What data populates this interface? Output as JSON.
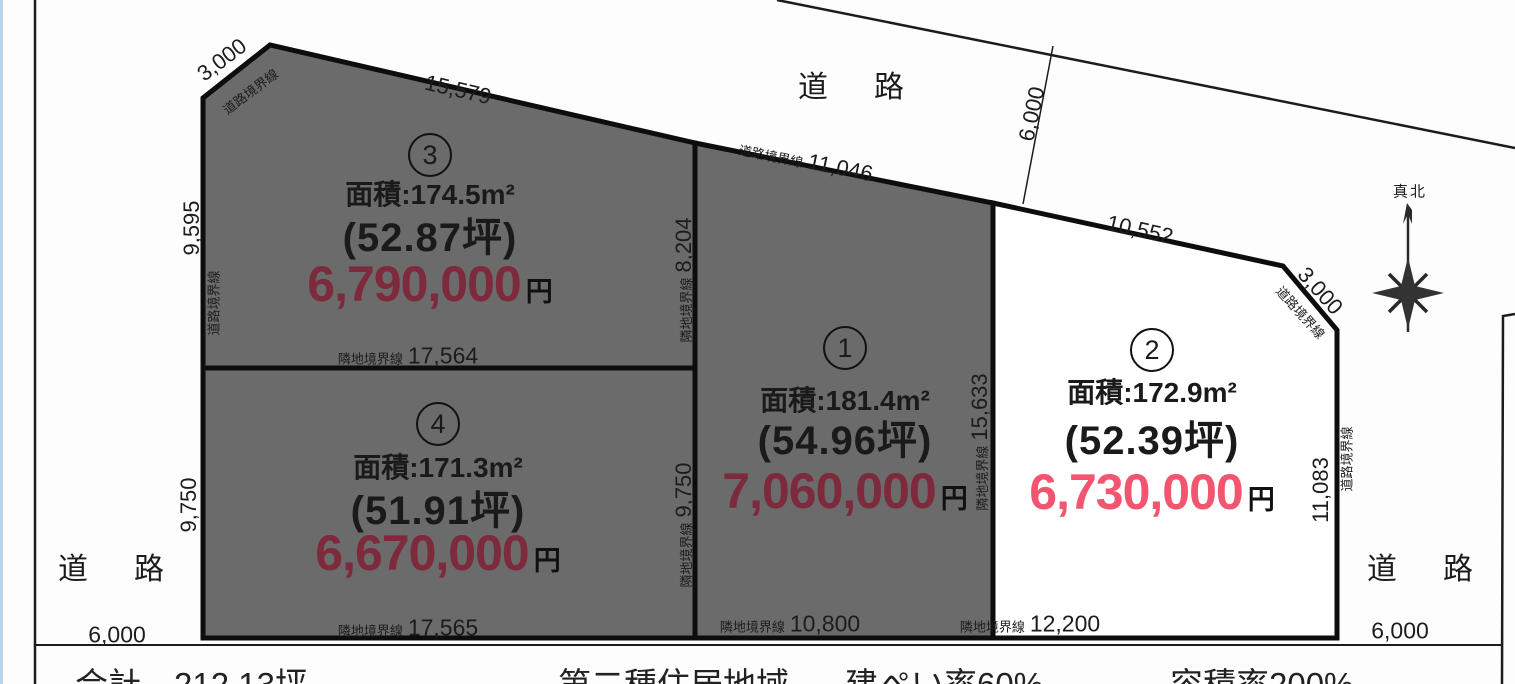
{
  "roads": {
    "north": "道　路",
    "west": "道　路",
    "east": "道　路"
  },
  "compass": {
    "label": "真北"
  },
  "lots": [
    {
      "number": "1",
      "area": "面積:181.4m²",
      "tsubo": "(54.96坪)",
      "price": "7,060,000",
      "unit": "円"
    },
    {
      "number": "2",
      "area": "面積:172.9m²",
      "tsubo": "(52.39坪)",
      "price": "6,730,000",
      "unit": "円"
    },
    {
      "number": "3",
      "area": "面積:174.5m²",
      "tsubo": "(52.87坪)",
      "price": "6,790,000",
      "unit": "円"
    },
    {
      "number": "4",
      "area": "面積:171.3m²",
      "tsubo": "(51.91坪)",
      "price": "6,670,000",
      "unit": "円"
    }
  ],
  "dims": {
    "nw_chamfer": {
      "label": "道路境界線",
      "value": "3,000"
    },
    "lot3_top": {
      "value": "15,579"
    },
    "lot3_left": {
      "value": "9,595"
    },
    "lot3_left_label": {
      "label": "道路境界線"
    },
    "b34": {
      "label": "隣地境界線",
      "value": "17,564"
    },
    "lot4_left": {
      "value": "9,750"
    },
    "lot4_bottom": {
      "label": "隣地境界線",
      "value": "17,565"
    },
    "west_road_width": {
      "value": "6,000"
    },
    "b31": {
      "label": "隣地境界線",
      "value": "8,204"
    },
    "b41": {
      "label": "隣地境界線",
      "value": "9,750"
    },
    "lot1_top": {
      "label": "道路境界線",
      "value": "11,046"
    },
    "b12": {
      "label": "隣地境界線",
      "value": "15,633"
    },
    "lot1_bottom": {
      "label": "隣地境界線",
      "value": "10,800"
    },
    "lot2_top": {
      "value": "10,552"
    },
    "ne_chamfer": {
      "label": "道路境界線",
      "value": "3,000"
    },
    "lot2_right": {
      "label": "道路境界線",
      "value": "11,083"
    },
    "lot2_bottom": {
      "label": "隣地境界線",
      "value": "12,200"
    },
    "north_road_width": {
      "value": "6,000"
    },
    "east_road_width": {
      "value": "6,000"
    }
  },
  "caption": {
    "total": "合計　212.13坪",
    "zoning": "第二種住居地域",
    "building_coverage": "建ぺい率60%",
    "floor_area_ratio": "容積率200%"
  },
  "colors": {
    "parcel_fill": "#6b6b6b",
    "price_dark": "#7d2a3c",
    "price_bright": "#f25570"
  }
}
